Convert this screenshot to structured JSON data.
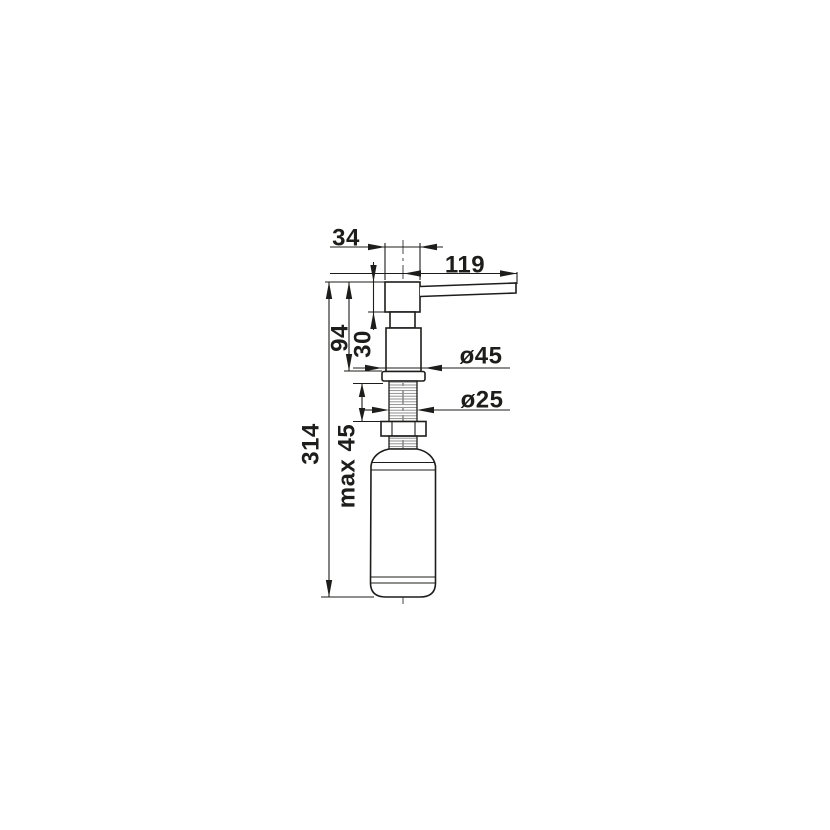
{
  "drawing": {
    "title": "soap-dispenser-dimension-drawing",
    "colors": {
      "ink": "#1d1d1b",
      "background": "#ffffff",
      "thread_hatch": "#8b8b8b"
    },
    "dimensions": [
      {
        "id": "head-width",
        "label": "34",
        "orientation": "horizontal"
      },
      {
        "id": "spout-reach",
        "label": "119",
        "orientation": "horizontal"
      },
      {
        "id": "height-above-counter",
        "label": "94",
        "orientation": "vertical"
      },
      {
        "id": "head-height",
        "label": "30",
        "orientation": "vertical"
      },
      {
        "id": "flange-diameter",
        "label": "ø45",
        "orientation": "horizontal"
      },
      {
        "id": "shaft-diameter",
        "label": "ø25",
        "orientation": "horizontal"
      },
      {
        "id": "max-counter-thickness",
        "label": "max 45",
        "orientation": "vertical"
      },
      {
        "id": "total-height",
        "label": "314",
        "orientation": "vertical"
      }
    ]
  }
}
